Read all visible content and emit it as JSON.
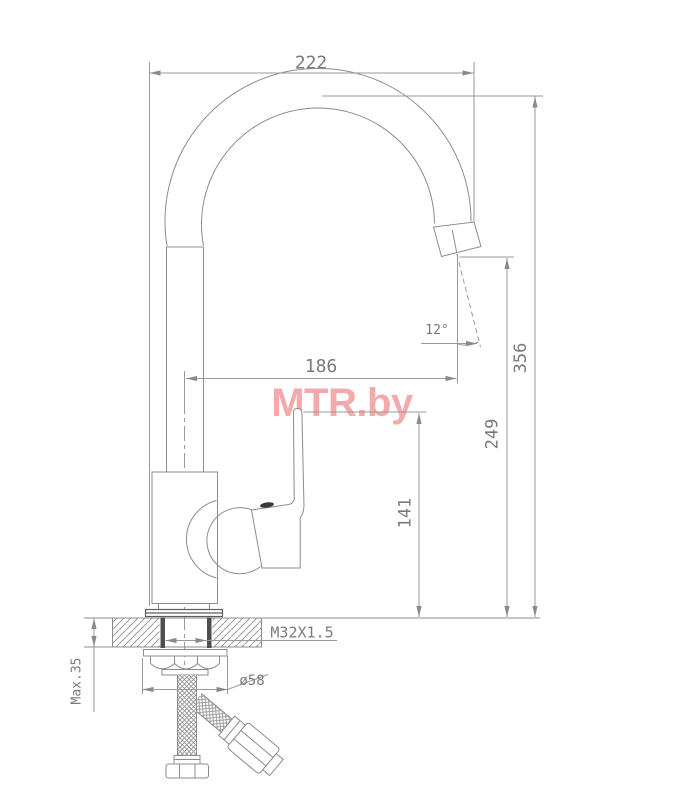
{
  "watermark": {
    "text": "MTR.by",
    "color": "#f4aaaa"
  },
  "dimensions": {
    "spout_width": "222",
    "total_height": "356",
    "spout_reach": "186",
    "outlet_height": "249",
    "handle_height": "141",
    "outlet_angle": "12°",
    "thread_size": "M32X1.5",
    "flange_diameter": "ø58",
    "max_deck_thickness": "Max.35"
  },
  "drawing": {
    "line_color": "#8c8c8c",
    "dim_text_color": "#7a7a7a",
    "dark_detail_color": "#4f4f4f",
    "background": "#ffffff"
  }
}
